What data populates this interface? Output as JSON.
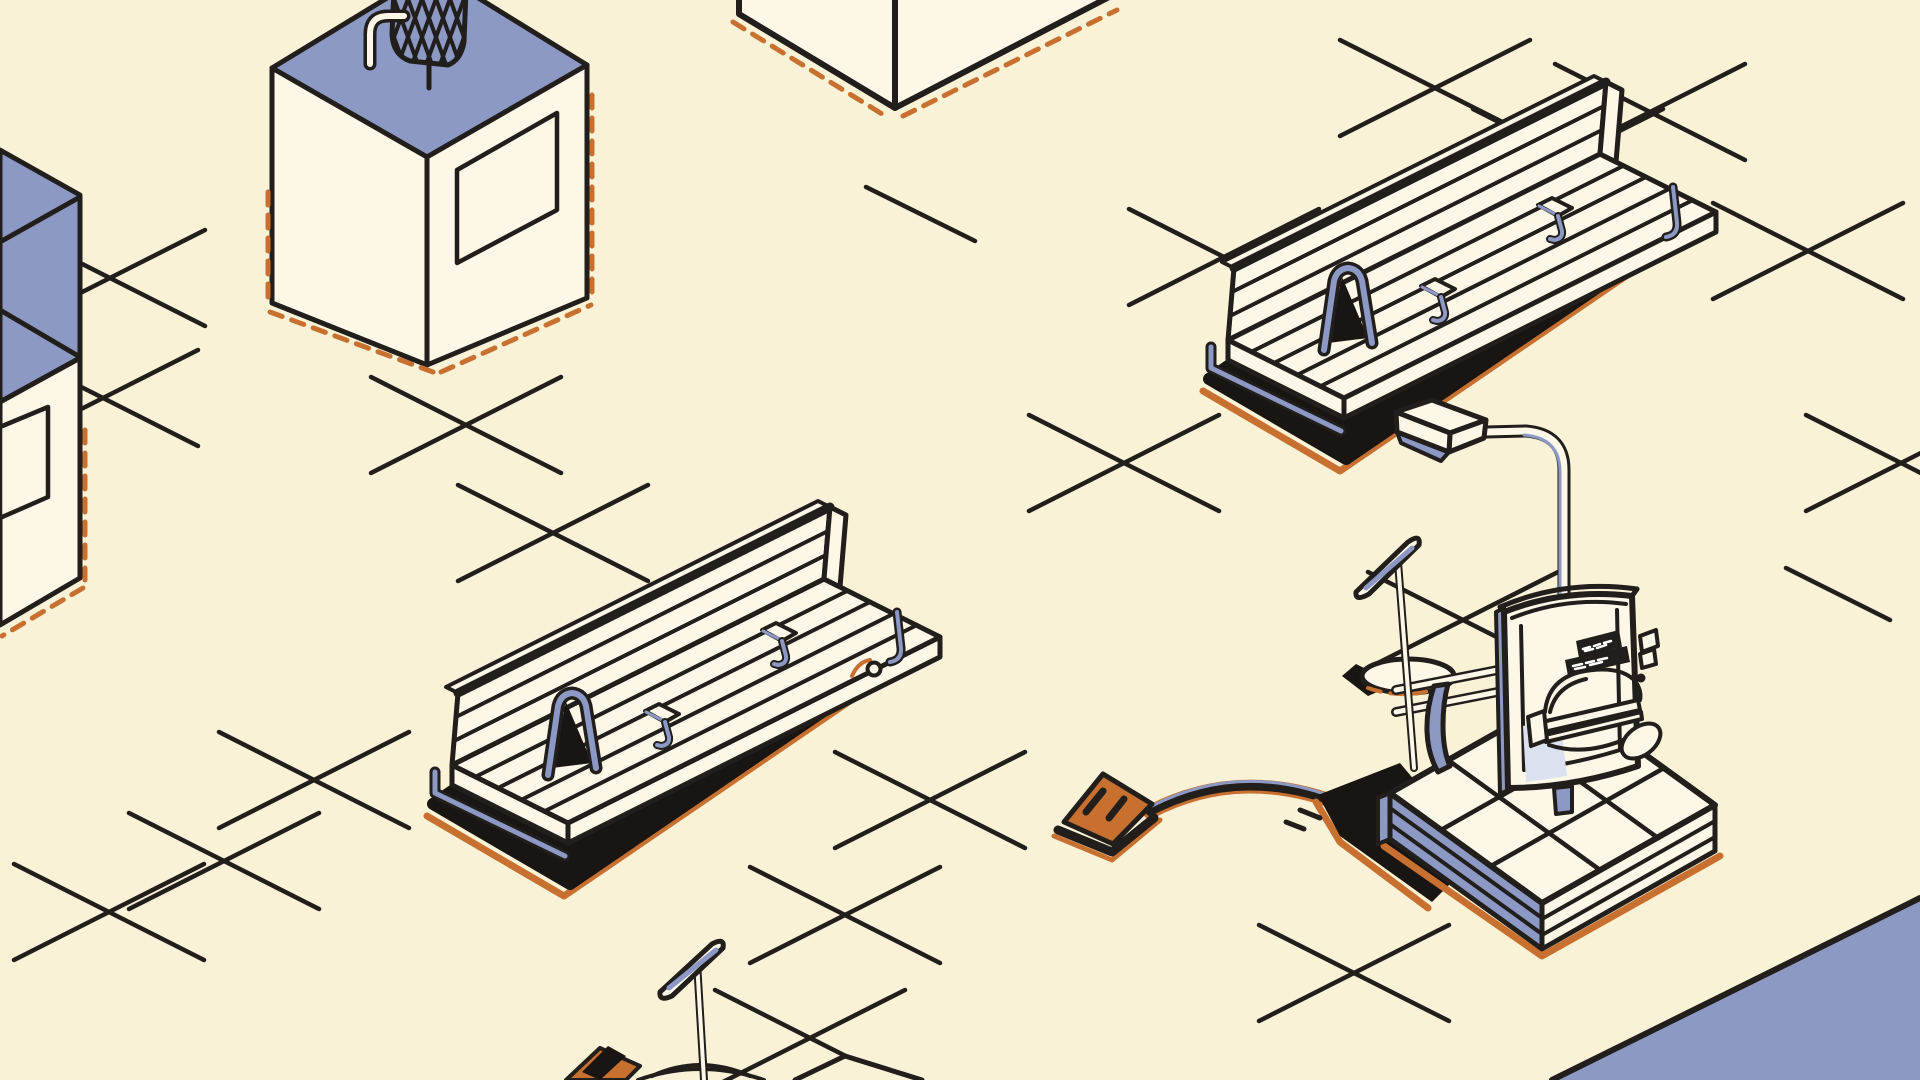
{
  "scene": {
    "title": "Isometric sandbox building scene",
    "description": "Cream isometric ground plane with grid corner marks, two park benches, a streetlamp with a burger sign machine on a tiled platform, cubic buildings with blue roofs, a rooftop wire basket, cable with wedge plug, and small paddle signs"
  },
  "palette": {
    "bg": "#F9F2D7",
    "cream": "#FCF7E7",
    "blue": "#8C99C4",
    "panel": "#DCE1F0",
    "orange": "#C8702F",
    "line": "#211E1B",
    "shadow": "#181512",
    "white": "#FFFFFF"
  },
  "objects": [
    {
      "name": "building-left",
      "kind": "blue-roof building, clipped at left edge"
    },
    {
      "name": "building-basket",
      "kind": "blue-roof building with rooftop wire basket and spout"
    },
    {
      "name": "building-cube",
      "kind": "floating cube corner, top edge"
    },
    {
      "name": "bench-1",
      "kind": "slatted park bench with backrest"
    },
    {
      "name": "bench-2",
      "kind": "slatted park bench with backrest"
    },
    {
      "name": "street-lamp",
      "kind": "curved streetlamp over sign machine"
    },
    {
      "name": "burger-sign",
      "kind": "curved signboard with burger doodle and black sticker"
    },
    {
      "name": "platform",
      "kind": "three-tier tiled platform"
    },
    {
      "name": "paddle-sign",
      "kind": "small paddle sign on thin pole with round base"
    },
    {
      "name": "paddle-sign-bottom",
      "kind": "small paddle sign at bottom edge"
    },
    {
      "name": "cable-wedge",
      "kind": "orange wedge plug with cable to platform"
    },
    {
      "name": "corner-wedge",
      "kind": "blue ground wedge, bottom-right corner"
    }
  ],
  "burger_sign": {
    "sticker_lines": 2
  }
}
